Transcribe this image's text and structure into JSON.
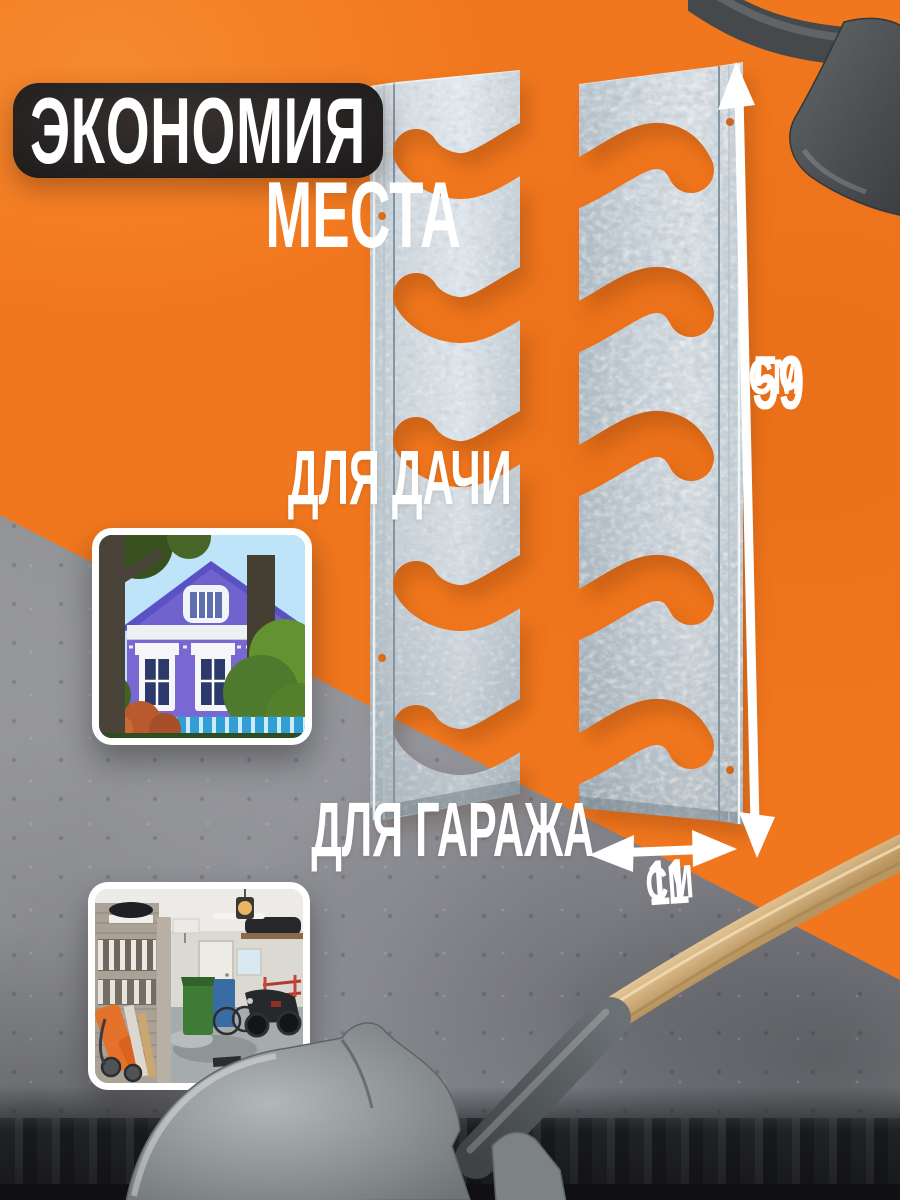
{
  "page": {
    "language": "ru",
    "kind": "product-promo-card"
  },
  "headline": {
    "line1": "ЭКОНОМИЯ",
    "line2": "МЕСТА"
  },
  "sections": {
    "dacha": {
      "label": "ДЛЯ ДАЧИ"
    },
    "garage": {
      "label": "ДЛЯ ГАРАЖА"
    }
  },
  "dimensions": {
    "height_value": "59",
    "height_unit": "СМ",
    "width_value": "11",
    "width_unit": "СМ"
  },
  "icons": {
    "height_arrow": "double-headed-vertical-arrow",
    "width_arrow": "double-headed-horizontal-arrow"
  },
  "colors": {
    "orange": "#f1771e",
    "concrete": "#8f9094",
    "banner_black": "#1d1a1b",
    "text_white": "#ffffff",
    "metal_zinc": "#ccd5db",
    "shovel_gray": "#5c6063",
    "wood_handle": "#d7b686",
    "dark_band": "#212225"
  }
}
